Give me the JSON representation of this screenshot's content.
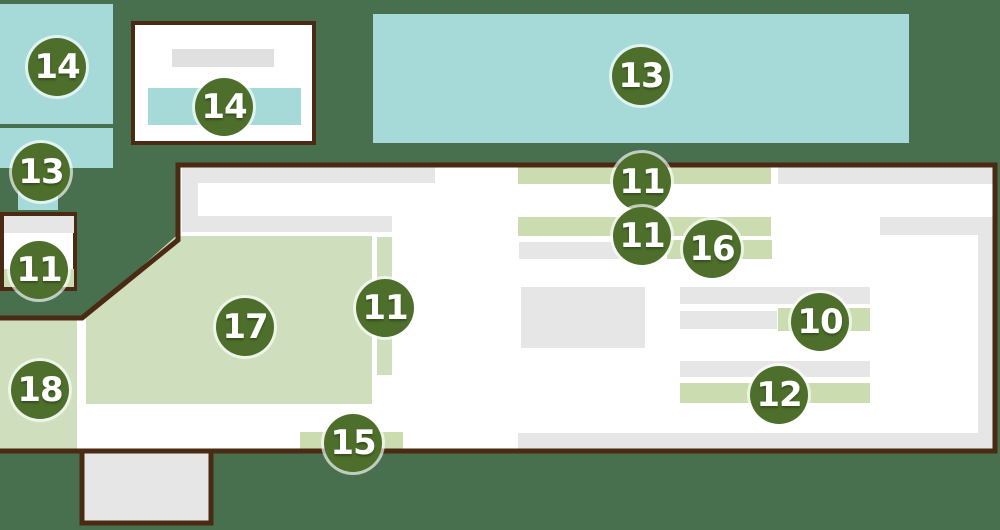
{
  "colors": {
    "background": "#48704f",
    "border-brown": "#4a2a12",
    "teal": "#a6dad8",
    "green-block": "#cfdebc",
    "green-bar": "#cbdcb0",
    "gray": "#e6e6e6",
    "gray-dark": "#e0e0e0",
    "white": "#ffffff",
    "badge-bg": "#4d6f2b",
    "badge-text": "#ffffff"
  },
  "markers": [
    {
      "label": "14",
      "x": 57,
      "y": 67
    },
    {
      "label": "14",
      "x": 224,
      "y": 107
    },
    {
      "label": "13",
      "x": 641,
      "y": 76
    },
    {
      "label": "13",
      "x": 41,
      "y": 172
    },
    {
      "label": "11",
      "x": 39,
      "y": 270
    },
    {
      "label": "11",
      "x": 642,
      "y": 182
    },
    {
      "label": "11",
      "x": 642,
      "y": 236
    },
    {
      "label": "16",
      "x": 712,
      "y": 249
    },
    {
      "label": "17",
      "x": 245,
      "y": 327
    },
    {
      "label": "11",
      "x": 385,
      "y": 308
    },
    {
      "label": "10",
      "x": 820,
      "y": 322
    },
    {
      "label": "12",
      "x": 779,
      "y": 395
    },
    {
      "label": "15",
      "x": 353,
      "y": 443
    },
    {
      "label": "18",
      "x": 40,
      "y": 390
    }
  ]
}
